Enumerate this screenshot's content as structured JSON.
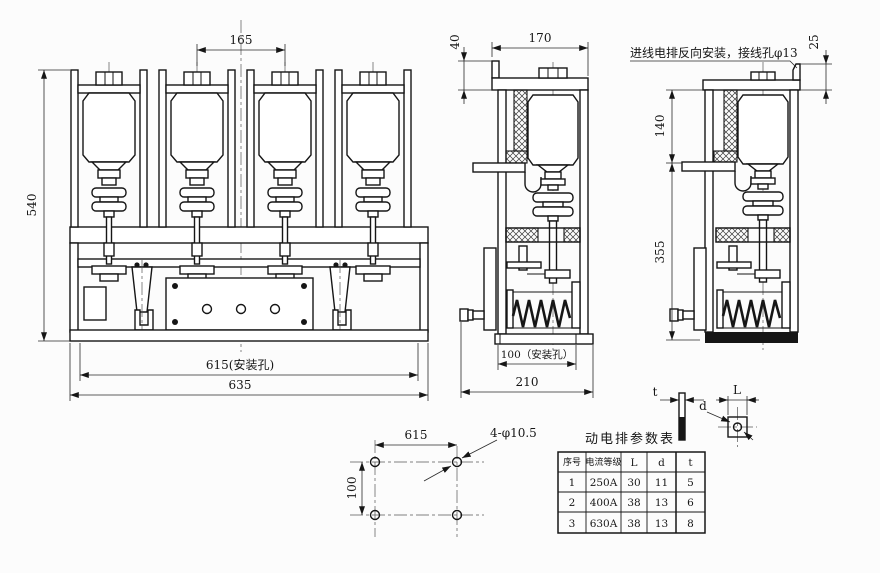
{
  "front_view": {
    "height": "540",
    "pole_pitch": "165",
    "mount_width": "615(安装孔)",
    "overall_width": "635"
  },
  "side_view": {
    "top_offset": "40",
    "depth": "170",
    "mount_depth": "100（安装孔）",
    "overall_depth": "210"
  },
  "reversed_view": {
    "note": "进线电排反向安装，接线孔φ13",
    "tab_height": "25",
    "upper": "140",
    "lower": "355"
  },
  "mount_plan": {
    "width": "615",
    "height": "100",
    "holes_label": "4-φ10.5"
  },
  "busbar_detail": {
    "thickness_label": "t",
    "width_label": "L",
    "hole_label": "d"
  },
  "table": {
    "title": "动电排参数表",
    "headers": [
      "序号",
      "电流等级",
      "L",
      "d",
      "t"
    ],
    "rows": [
      [
        "1",
        "250A",
        "30",
        "11",
        "5"
      ],
      [
        "2",
        "400A",
        "38",
        "13",
        "6"
      ],
      [
        "3",
        "630A",
        "38",
        "13",
        "8"
      ]
    ]
  },
  "colors": {
    "line": "#161616",
    "background": "#fcfcfc"
  }
}
